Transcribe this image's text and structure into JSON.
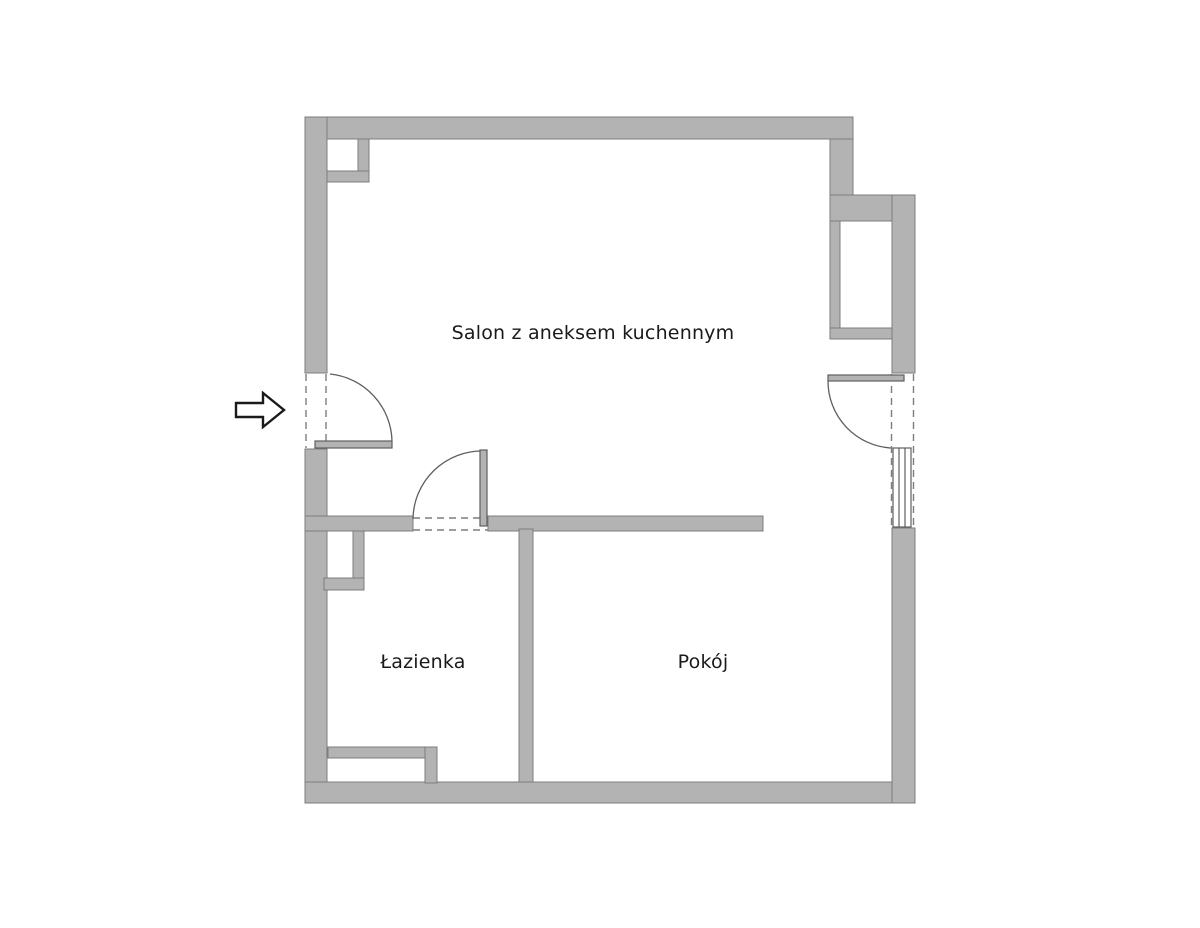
{
  "plan": {
    "canvas": {
      "width": 1200,
      "height": 928
    },
    "colors": {
      "background": "#ffffff",
      "wall_fill": "#b3b3b3",
      "wall_outline": "#7d7d7d",
      "door_stroke": "#5f5f5f",
      "dash_stroke": "#7d7d7d",
      "label_color": "#1a1a1a",
      "arrow_stroke": "#1a1a1a",
      "arrow_fill": "#ffffff"
    },
    "walls": [
      {
        "name": "top-wall",
        "x": 305,
        "y": 117,
        "w": 548,
        "h": 22
      },
      {
        "name": "left-wall-upper",
        "x": 305,
        "y": 117,
        "w": 22,
        "h": 256
      },
      {
        "name": "left-wall-lower",
        "x": 305,
        "y": 449,
        "w": 22,
        "h": 354
      },
      {
        "name": "bottom-wall",
        "x": 305,
        "y": 782,
        "w": 610,
        "h": 21
      },
      {
        "name": "step-out-vertical",
        "x": 830,
        "y": 139,
        "w": 23,
        "h": 56
      },
      {
        "name": "step-out-band",
        "x": 830,
        "y": 195,
        "w": 85,
        "h": 26
      },
      {
        "name": "shaft-left-strip",
        "x": 830,
        "y": 221,
        "w": 10,
        "h": 118
      },
      {
        "name": "shaft-bottom-band",
        "x": 830,
        "y": 328,
        "w": 62,
        "h": 11
      },
      {
        "name": "right-wall-upper",
        "x": 892,
        "y": 195,
        "w": 23,
        "h": 178
      },
      {
        "name": "right-wall-lower",
        "x": 892,
        "y": 528,
        "w": 23,
        "h": 275
      },
      {
        "name": "bathroom-top-wall",
        "x": 305,
        "y": 516,
        "w": 108,
        "h": 15
      },
      {
        "name": "salon-pokoj-wall",
        "x": 488,
        "y": 516,
        "w": 275,
        "h": 15
      },
      {
        "name": "bathroom-pokoj-wall",
        "x": 519,
        "y": 529,
        "w": 14,
        "h": 253
      },
      {
        "name": "corner-duct-vbar",
        "x": 358,
        "y": 139,
        "w": 11,
        "h": 43
      },
      {
        "name": "corner-duct-hbar",
        "x": 327,
        "y": 171,
        "w": 42,
        "h": 11
      },
      {
        "name": "bath-duct-vbar",
        "x": 353,
        "y": 531,
        "w": 11,
        "h": 59
      },
      {
        "name": "bath-duct-hbar",
        "x": 324,
        "y": 578,
        "w": 40,
        "h": 12
      },
      {
        "name": "bath-recess-hbar",
        "x": 328,
        "y": 747,
        "w": 109,
        "h": 11
      },
      {
        "name": "bath-recess-vbar",
        "x": 425,
        "y": 747,
        "w": 12,
        "h": 36
      }
    ],
    "dashed_lines": [
      {
        "name": "entrance-jamb-inner",
        "x1": 306,
        "y1": 374,
        "x2": 306,
        "y2": 448
      },
      {
        "name": "entrance-jamb-outer",
        "x1": 326,
        "y1": 374,
        "x2": 326,
        "y2": 448
      },
      {
        "name": "bathdoor-jamb-top",
        "x1": 413,
        "y1": 518,
        "x2": 488,
        "y2": 518
      },
      {
        "name": "bathdoor-jamb-bottom",
        "x1": 413,
        "y1": 530,
        "x2": 488,
        "y2": 530
      },
      {
        "name": "window-jamb-inner",
        "x1": 891.5,
        "y1": 374,
        "x2": 891.5,
        "y2": 527
      },
      {
        "name": "window-jamb-outer",
        "x1": 913.5,
        "y1": 374,
        "x2": 913.5,
        "y2": 527
      }
    ],
    "doors": [
      {
        "name": "entrance-door",
        "leaf": {
          "x": 315,
          "y": 441,
          "w": 77,
          "h": 7
        },
        "arc": "M 330 374 A 69 69 0 0 1 392 441"
      },
      {
        "name": "bathroom-door",
        "leaf": {
          "x": 480,
          "y": 450,
          "w": 7,
          "h": 76
        },
        "arc": "M 413 519 A 69 69 0 0 1 483 451"
      },
      {
        "name": "balcony-door",
        "leaf": {
          "x": 828,
          "y": 375,
          "w": 76,
          "h": 6
        },
        "arc": "M 828 381 A 67 67 0 0 0 891 448"
      }
    ],
    "window": {
      "name": "right-window",
      "frame": {
        "x": 893,
        "y": 448,
        "w": 18,
        "h": 79
      },
      "mullions": [
        {
          "x1": 899,
          "y1": 448,
          "x2": 899,
          "y2": 527
        },
        {
          "x1": 905,
          "y1": 448,
          "x2": 905,
          "y2": 527
        }
      ]
    },
    "entrance_arrow": {
      "points": "236,403 263,403 263,393 284,410 263,427 263,417 236,417"
    }
  },
  "rooms": [
    {
      "id": "salon",
      "label": "Salon z aneksem kuchennym",
      "cx": 593,
      "cy": 333
    },
    {
      "id": "lazienka",
      "label": "Łazienka",
      "cx": 423,
      "cy": 662
    },
    {
      "id": "pokoj",
      "label": "Pokój",
      "cx": 703,
      "cy": 662
    }
  ]
}
